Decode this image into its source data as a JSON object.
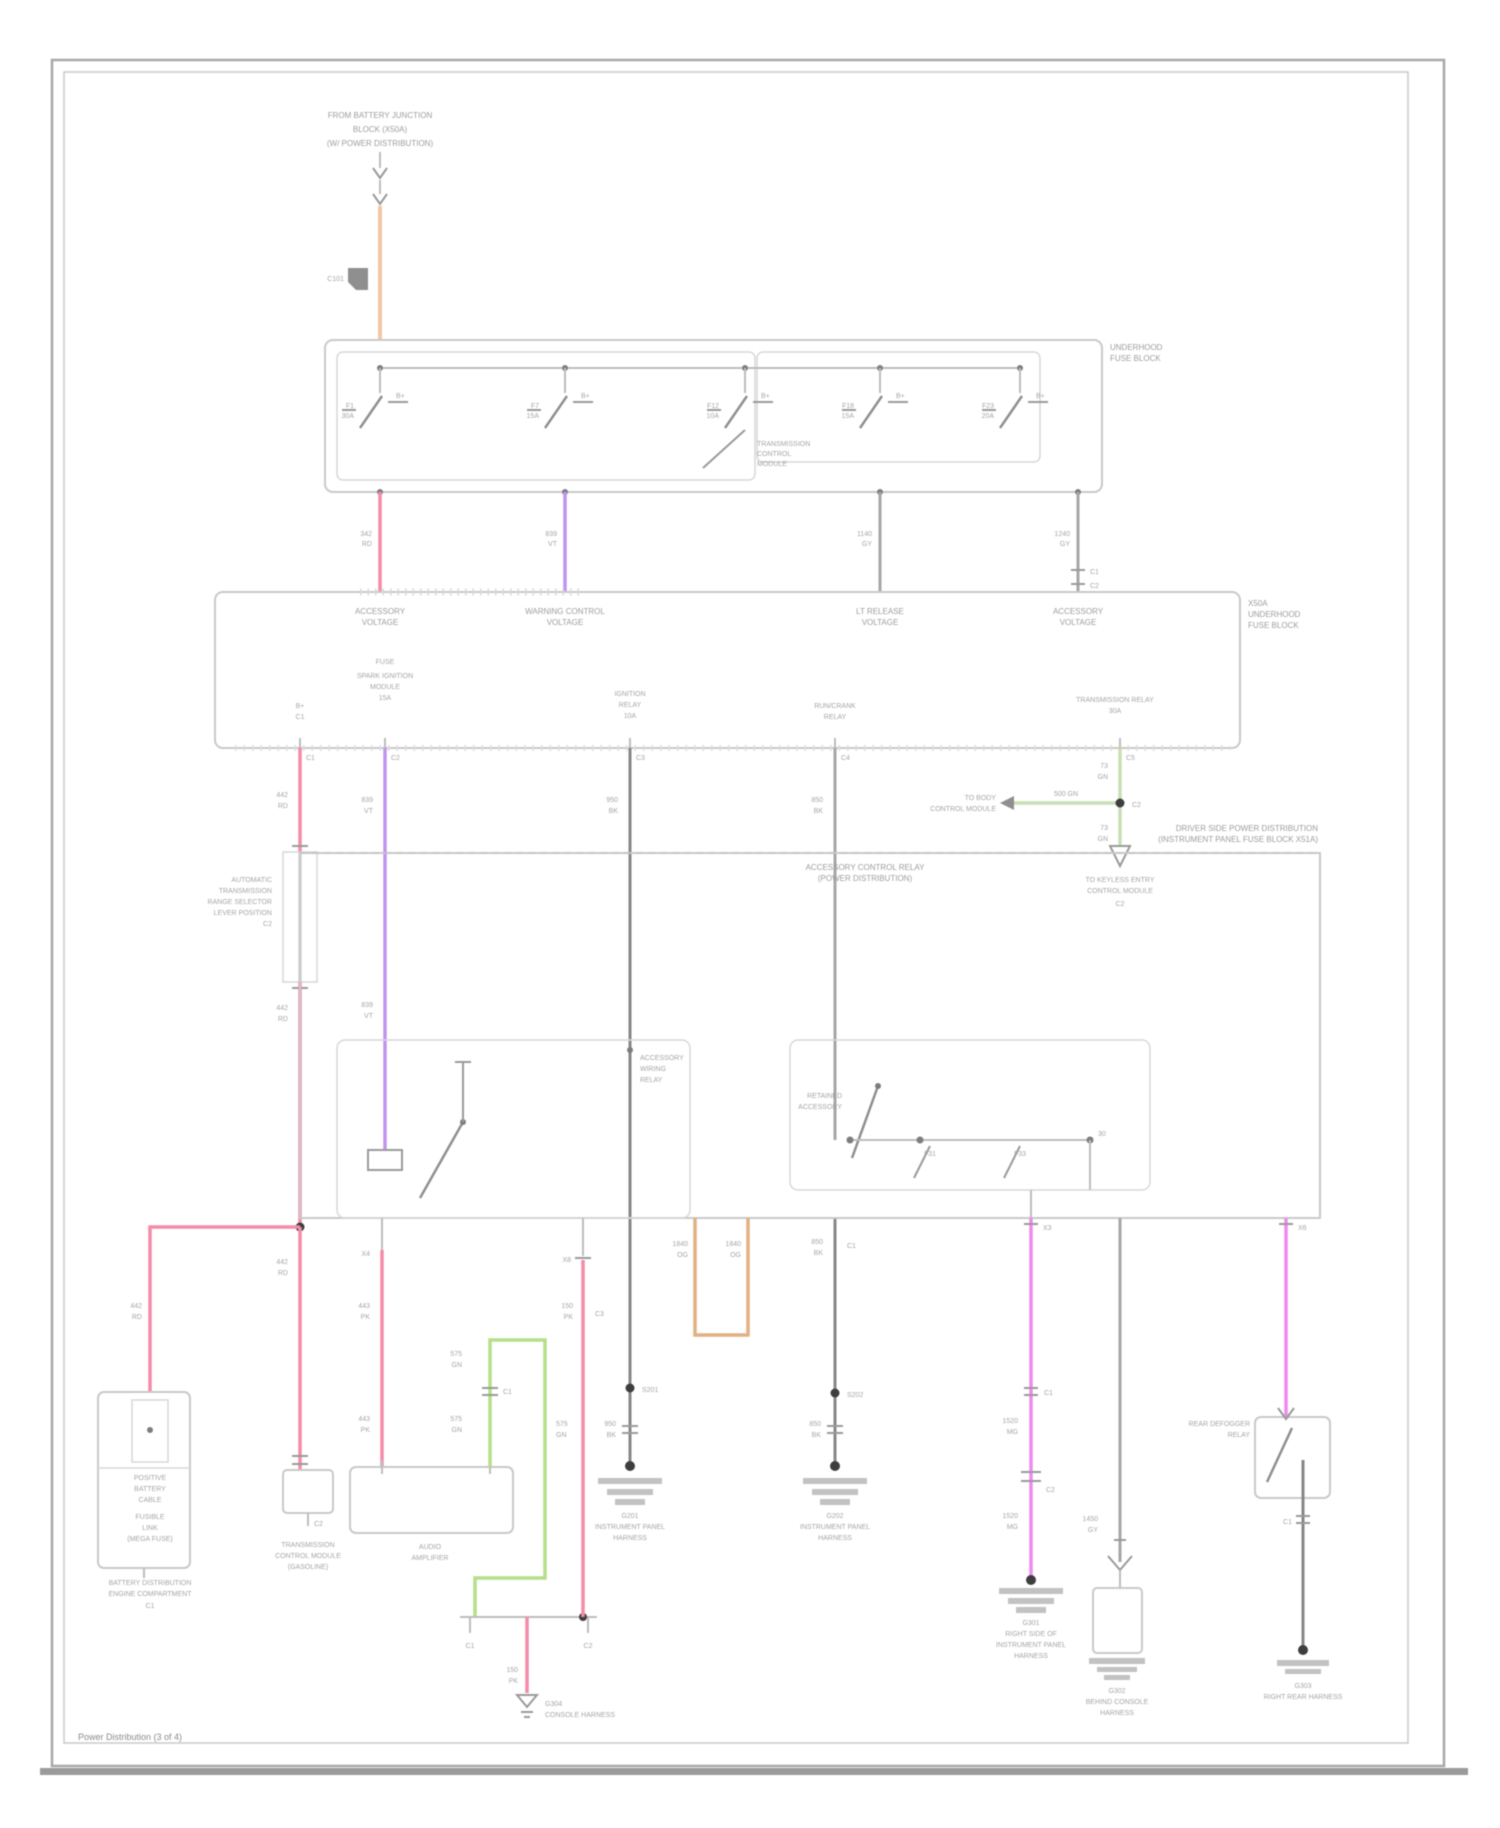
{
  "page": {
    "caption": "Power Distribution (3 of 4)"
  },
  "tf": {
    "l1": "FROM BATTERY JUNCTION",
    "l2": "BLOCK (X50A)",
    "l3": "(W/ POWER DISTRIBUTION)",
    "tag": "C101"
  },
  "fb": {
    "c1": "UNDERHOOD",
    "c2": "FUSE BLOCK",
    "f": [
      {
        "a": "F1",
        "b": "30A",
        "r": "B+"
      },
      {
        "a": "F7",
        "b": "15A",
        "r": "B+"
      },
      {
        "a": "F12",
        "b": "10A",
        "r": "B+"
      },
      {
        "a": "F18",
        "b": "15A",
        "r": "B+"
      },
      {
        "a": "F23",
        "b": "20A",
        "r": "B+"
      }
    ],
    "x": [
      "TRANSMISSION",
      "CONTROL",
      "MODULE"
    ]
  },
  "fd": {
    "w1a": "342",
    "w1b": "RD",
    "w2a": "839",
    "w2b": "VT",
    "w3a": "1140",
    "w3b": "GY",
    "w4a": "1240",
    "w4b": "GY",
    "c1": "C1",
    "c2": "C2"
  },
  "jb": {
    "t1a": "ACCESSORY",
    "t1b": "VOLTAGE",
    "t2a": "WARNING CONTROL",
    "t2b": "VOLTAGE",
    "t3a": "LT RELEASE",
    "t3b": "VOLTAGE",
    "t4a": "ACCESSORY",
    "t4b": "VOLTAGE",
    "r1": "X50A",
    "r2": "UNDERHOOD",
    "r3": "FUSE BLOCK",
    "b1a": "B+",
    "b1b": "C1",
    "b2a": "FUSE",
    "b2b": "SPARK IGNITION",
    "b2c": "MODULE",
    "b2d": "15A",
    "b3a": "IGNITION",
    "b3b": "RELAY",
    "b3c": "10A",
    "b4a": "RUN/CRANK",
    "b4b": "RELAY",
    "b5a": "TRANSMISSION RELAY",
    "b5b": "30A",
    "p1": "C1",
    "p2": "C2",
    "p3": "C3",
    "p4": "C4",
    "p5": "C5"
  },
  "d1": {
    "a1": "442",
    "a2": "RD",
    "c1": "AUTOMATIC",
    "c2": "TRANSMISSION",
    "c3": "RANGE SELECTOR",
    "c4": "LEVER POSITION",
    "c5": "C2",
    "b1": "442",
    "b2": "RD",
    "e1": "442",
    "e2": "RD",
    "f1": "442",
    "f2": "RD",
    "p": "C2",
    "g1": "TRANSMISSION",
    "g2": "CONTROL MODULE",
    "g3": "(GASOLINE)"
  },
  "d2": {
    "a1": "839",
    "a2": "VT",
    "b1": "839",
    "b2": "VT"
  },
  "d3": {
    "a1": "950",
    "a2": "BK",
    "s": "S201",
    "b1": "950",
    "b2": "BK"
  },
  "d4": {
    "a1": "850",
    "a2": "BK",
    "b1": "850",
    "b2": "BK",
    "c": "C1",
    "s": "S202",
    "d1": "850",
    "d2": "BK"
  },
  "d5": {
    "a1": "73",
    "a2": "GN",
    "t": "500 GN",
    "m1": "TO BODY",
    "m2": "CONTROL MODULE",
    "c": "C2",
    "b1": "73",
    "b2": "GN",
    "n1": "TO KEYLESS ENTRY",
    "n2": "CONTROL MODULE",
    "c2": "C2"
  },
  "ip": {
    "a1": "DRIVER SIDE POWER DISTRIBUTION",
    "a2": "(INSTRUMENT PANEL FUSE BLOCK X51A)",
    "t1": "ACCESSORY CONTROL RELAY",
    "t2": "(POWER DISTRIBUTION)",
    "lr1": "ACCESSORY",
    "lr2": "WIRING",
    "lr3": "RELAY",
    "rr1": "RETAINED",
    "rr2": "ACCESSORY",
    "f1": "F31",
    "f2": "F33",
    "f3": "30"
  },
  "ctr": {
    "p": "X4",
    "a1": "443",
    "a2": "PK",
    "b1": "443",
    "b2": "PK",
    "box1": "AUDIO",
    "box2": "AMPLIFIER",
    "g1": "575",
    "g2": "GN",
    "g3": "575",
    "g4": "GN",
    "gc": "C1",
    "g5": "575",
    "g6": "GN",
    "s1": "C1",
    "s2": "C2",
    "d1": "150",
    "d2": "PK",
    "e1": "G304",
    "e2": "CONSOLE HARNESS"
  },
  "p583": {
    "p": "X8",
    "a1": "150",
    "a2": "PK",
    "b1": "150",
    "b2": "PK",
    "c": "C3"
  },
  "org": {
    "a1": "1840",
    "a2": "OG",
    "b1": "1840",
    "b2": "OG"
  },
  "mg1": {
    "p": "X3",
    "c1": "C1",
    "a1": "1520",
    "a2": "MG",
    "c2": "C2",
    "b1": "1520",
    "b2": "MG"
  },
  "gy2": {
    "a1": "1450",
    "a2": "GY"
  },
  "mg2": {
    "p": "X6",
    "a1": "REAR DEFOGGER",
    "a2": "RELAY",
    "c": "C1"
  },
  "bat": {
    "a1": "POSITIVE",
    "a2": "BATTERY",
    "a3": "CABLE",
    "b1": "FUSIBLE",
    "b2": "LINK",
    "b3": "(MEGA FUSE)",
    "c1": "BATTERY DISTRIBUTION",
    "c2": "ENGINE COMPARTMENT",
    "c3": "C1"
  },
  "g": {
    "g1a": "G201",
    "g1b": "INSTRUMENT PANEL",
    "g1c": "HARNESS",
    "g2a": "G202",
    "g2b": "INSTRUMENT PANEL",
    "g2c": "HARNESS",
    "g3a": "G301",
    "g3b": "RIGHT SIDE OF",
    "g3c": "INSTRUMENT PANEL",
    "g3d": "HARNESS",
    "g4a": "G302",
    "g4b": "BEHIND CONSOLE",
    "g4c": "HARNESS",
    "g5a": "G303",
    "g5b": "RIGHT REAR HARNESS"
  }
}
